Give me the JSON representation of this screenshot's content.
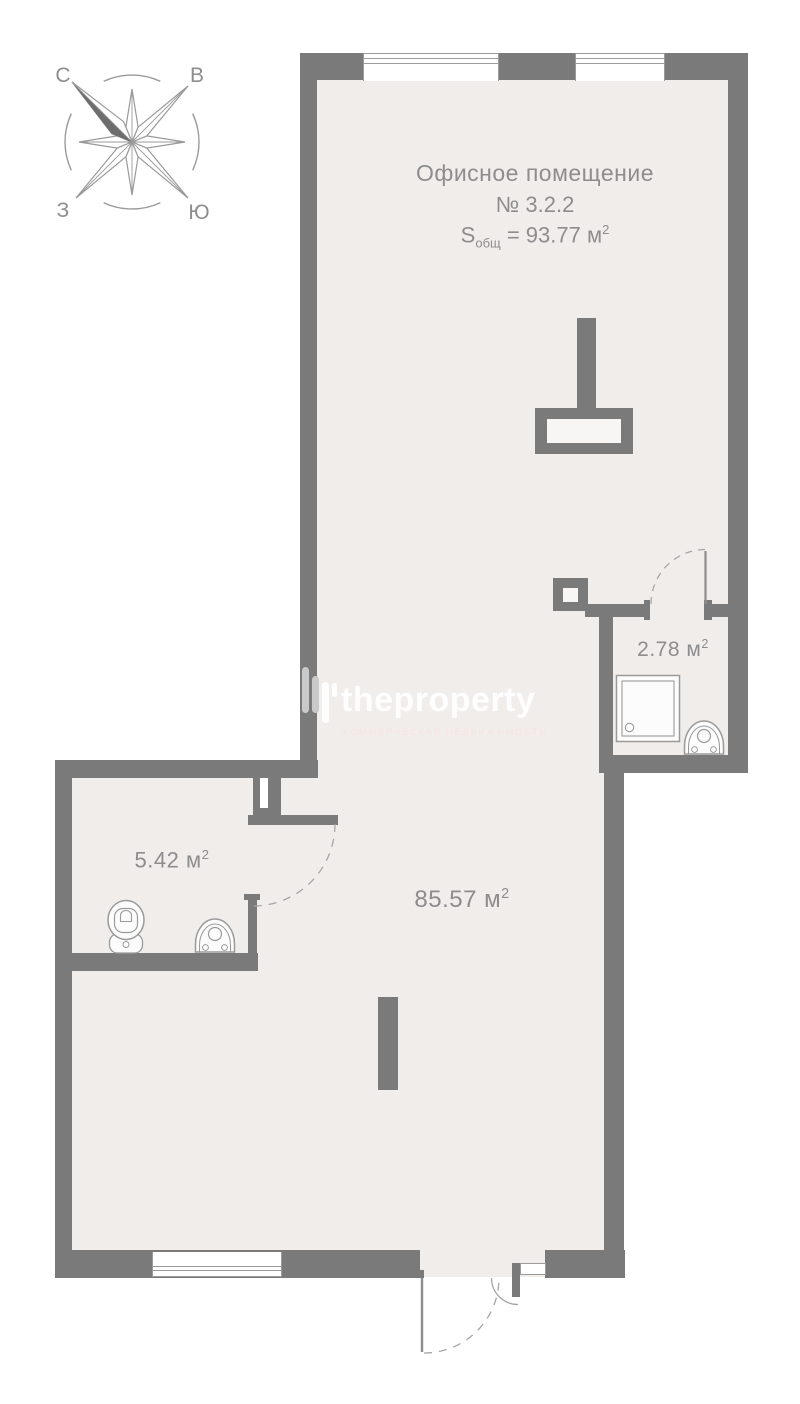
{
  "canvas": {
    "width": 800,
    "height": 1404
  },
  "colors": {
    "wall": "#7a7a7a",
    "floor": "#f1edeb",
    "thin_line": "#9b9b9b",
    "text": "#8d8d8d",
    "compass_dark_fill": "#6d6d6d",
    "watermark_brand": "#ffffff",
    "watermark_tagline": "#f8e4df",
    "logo_bar_gray": "#c9c9c9"
  },
  "compass": {
    "north": "С",
    "east": "В",
    "west": "З",
    "south": "Ю"
  },
  "title": {
    "line1": "Офисное помещение",
    "line2": "№ 3.2.2",
    "s_prefix": "S",
    "s_sub": "общ",
    "s_mid": " = 93.77 м",
    "s_sup": "2"
  },
  "rooms": {
    "main": {
      "value": "85.57 м",
      "sup": "2"
    },
    "wc": {
      "value": "5.42 м",
      "sup": "2"
    },
    "shower": {
      "value": "2.78 м",
      "sup": "2"
    }
  },
  "watermark": {
    "brand": "theproperty",
    "tagline": "КОММЕРЧЕСКАЯ НЕДВИЖИМОСТЬ"
  }
}
